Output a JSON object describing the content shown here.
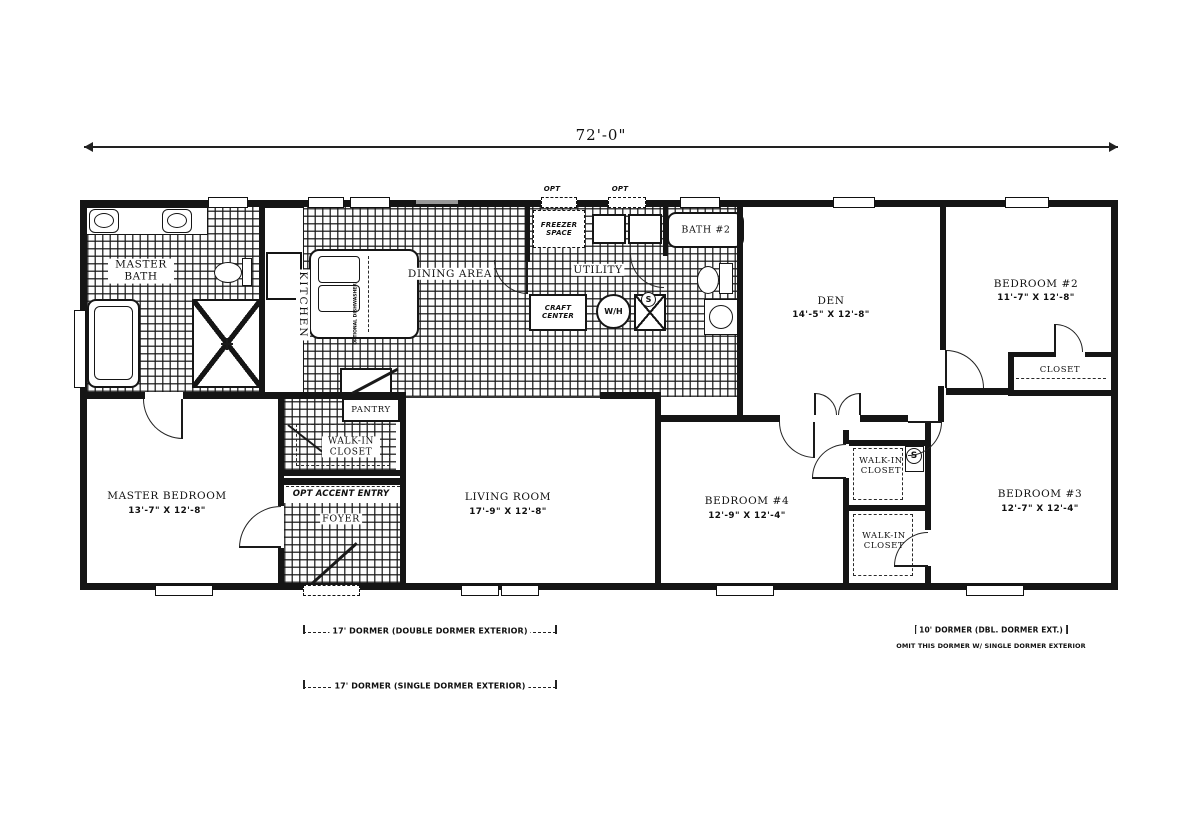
{
  "dimension": {
    "overall_width": "72'-0\""
  },
  "rooms": {
    "master_bath": {
      "label": "MASTER BATH"
    },
    "kitchen": {
      "label": "KITCHEN"
    },
    "dining": {
      "label": "DINING AREA"
    },
    "utility": {
      "label": "UTILITY"
    },
    "bath2": {
      "label": "BATH #2"
    },
    "den": {
      "label": "DEN",
      "dims": "14'-5\" X 12'-8\""
    },
    "bedroom2": {
      "label": "BEDROOM #2",
      "dims": "11'-7\" X 12'-8\""
    },
    "closet_bedroom2": {
      "label": "CLOSET"
    },
    "master_bedroom": {
      "label": "MASTER BEDROOM",
      "dims": "13'-7\" X 12'-8\""
    },
    "pantry": {
      "label": "PANTRY"
    },
    "walkin_master": {
      "label": "WALK-IN CLOSET"
    },
    "opt_accent_entry": {
      "label": "OPT ACCENT ENTRY"
    },
    "foyer": {
      "label": "FOYER"
    },
    "living": {
      "label": "LIVING ROOM",
      "dims": "17'-9\" X 12'-8\""
    },
    "bedroom4": {
      "label": "BEDROOM #4",
      "dims": "12'-9\" X 12'-4\""
    },
    "walkin_a": {
      "label": "WALK-IN CLOSET"
    },
    "walkin_b": {
      "label": "WALK-IN CLOSET"
    },
    "bedroom3": {
      "label": "BEDROOM #3",
      "dims": "12'-7\" X 12'-4\""
    }
  },
  "fixtures": {
    "freezer_space": "FREEZER SPACE",
    "craft_center": "CRAFT CENTER",
    "water_heater": "W/H",
    "s_marker": "S",
    "opt_label": "OPT",
    "optional_dishwasher": "OPTIONAL DISHWASHER"
  },
  "annotations": {
    "dormer_double": "17' DORMER (DOUBLE DORMER EXTERIOR)",
    "dormer_single": "17' DORMER (SINGLE DORMER EXTERIOR)",
    "dormer_10": "10' DORMER (DBL. DORMER EXT.)",
    "dormer_omit": "OMIT THIS DORMER W/ SINGLE DORMER EXTERIOR"
  },
  "colors": {
    "ink": "#151515",
    "paper": "#ffffff"
  }
}
